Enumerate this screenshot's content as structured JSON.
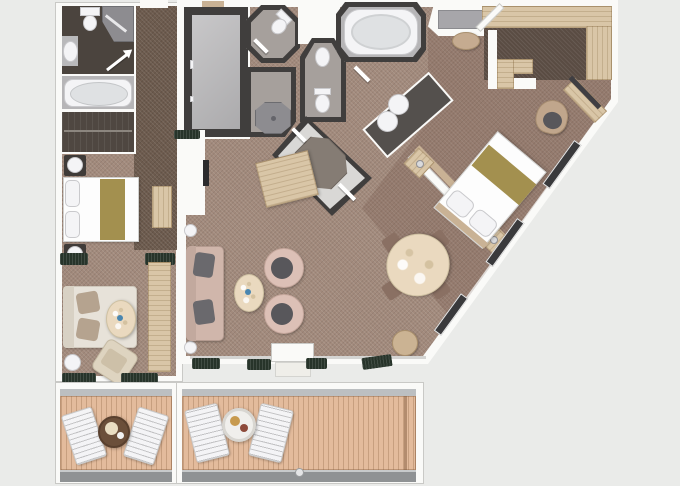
{
  "title": "Two-bedroom suite deck plan (top-down 3D floor plan, no text labels)",
  "palette": {
    "bg": "#eaebe9",
    "wall": "#fafaf8",
    "wall_edge": "#c9c9c6",
    "wall_dark": "#403e3d",
    "carpet_main": "#a28a7c",
    "carpet_dark": "#6d5b4e",
    "closet_floor": "#5a4c43",
    "bath_dark_floor": "#4b443e",
    "bath_grey_floor": "#a6a09c",
    "tile_grey": "#b6b5b7",
    "marble": "#d9d8d6",
    "shower": "#8d8c90",
    "inlay": "#857c74",
    "wood": "#d9c6a7",
    "wood_mid": "#c9b295",
    "deck": "#e3bb9c",
    "deck_line": "#c79f7f",
    "railing": "#8f9294",
    "fixture": "#f4f4f6",
    "tub_inner": "#dfe1e3",
    "counter_dark": "#54504d",
    "door_grey": "#a7a6aa",
    "sofa_pink": "#d0b6ab",
    "pillow_dark": "#6a696d",
    "pillow_taupe": "#b5a38f",
    "chair_pink": "#dcc0b6",
    "seat_dark": "#58575b",
    "sofa_cream": "#e7e2d9",
    "dining_chair": "#8a7063",
    "table_cream": "#ead9bf",
    "bed_white": "#fdfdfd",
    "bed_gold": "#a3904f",
    "plant": "#27342a",
    "accent_blue": "#4a86b0"
  },
  "left_suite": {
    "label": "Adjoining veranda suite",
    "rooms": [
      "bathroom",
      "wardrobe",
      "entry corridor",
      "bedroom / sitting room",
      "veranda"
    ],
    "fixtures": [
      "toilet",
      "corner shower",
      "washbasin",
      "bathtub"
    ],
    "furniture": [
      "queen bed with gold runner",
      "nightstand lamps",
      "dresser",
      "sofa with pillows",
      "oval coffee table",
      "armchair",
      "long sideboard",
      "window planters",
      "two sun loungers",
      "round deck table"
    ]
  },
  "main_suite": {
    "label": "Grand suite",
    "rooms": [
      "entrance vestibule",
      "utility closet",
      "WC room",
      "shower room",
      "second WC room",
      "bathtub room",
      "vanity area",
      "marble bath hall",
      "walk-in wardrobe",
      "dressing area",
      "master bedroom",
      "living room",
      "dining area",
      "veranda"
    ],
    "fixtures": [
      "large bathtub",
      "double washbasins",
      "octagonal shower",
      "two toilets",
      "towel rails"
    ],
    "furniture": [
      "king bed with gold runner",
      "two nightstands",
      "headboard wall",
      "desk and armchair",
      "L-shaped dressing counter",
      "ottoman",
      "sofa with grey pillows",
      "two swivel chairs",
      "oval coffee table",
      "sideboard",
      "oval dining table",
      "four dining chairs",
      "round side table",
      "window planters",
      "two sun loungers",
      "round deck table"
    ]
  },
  "verandas": {
    "label": "Teak verandas with railing",
    "items": [
      "sun lounger",
      "sun lounger",
      "deck table",
      "railing"
    ]
  }
}
